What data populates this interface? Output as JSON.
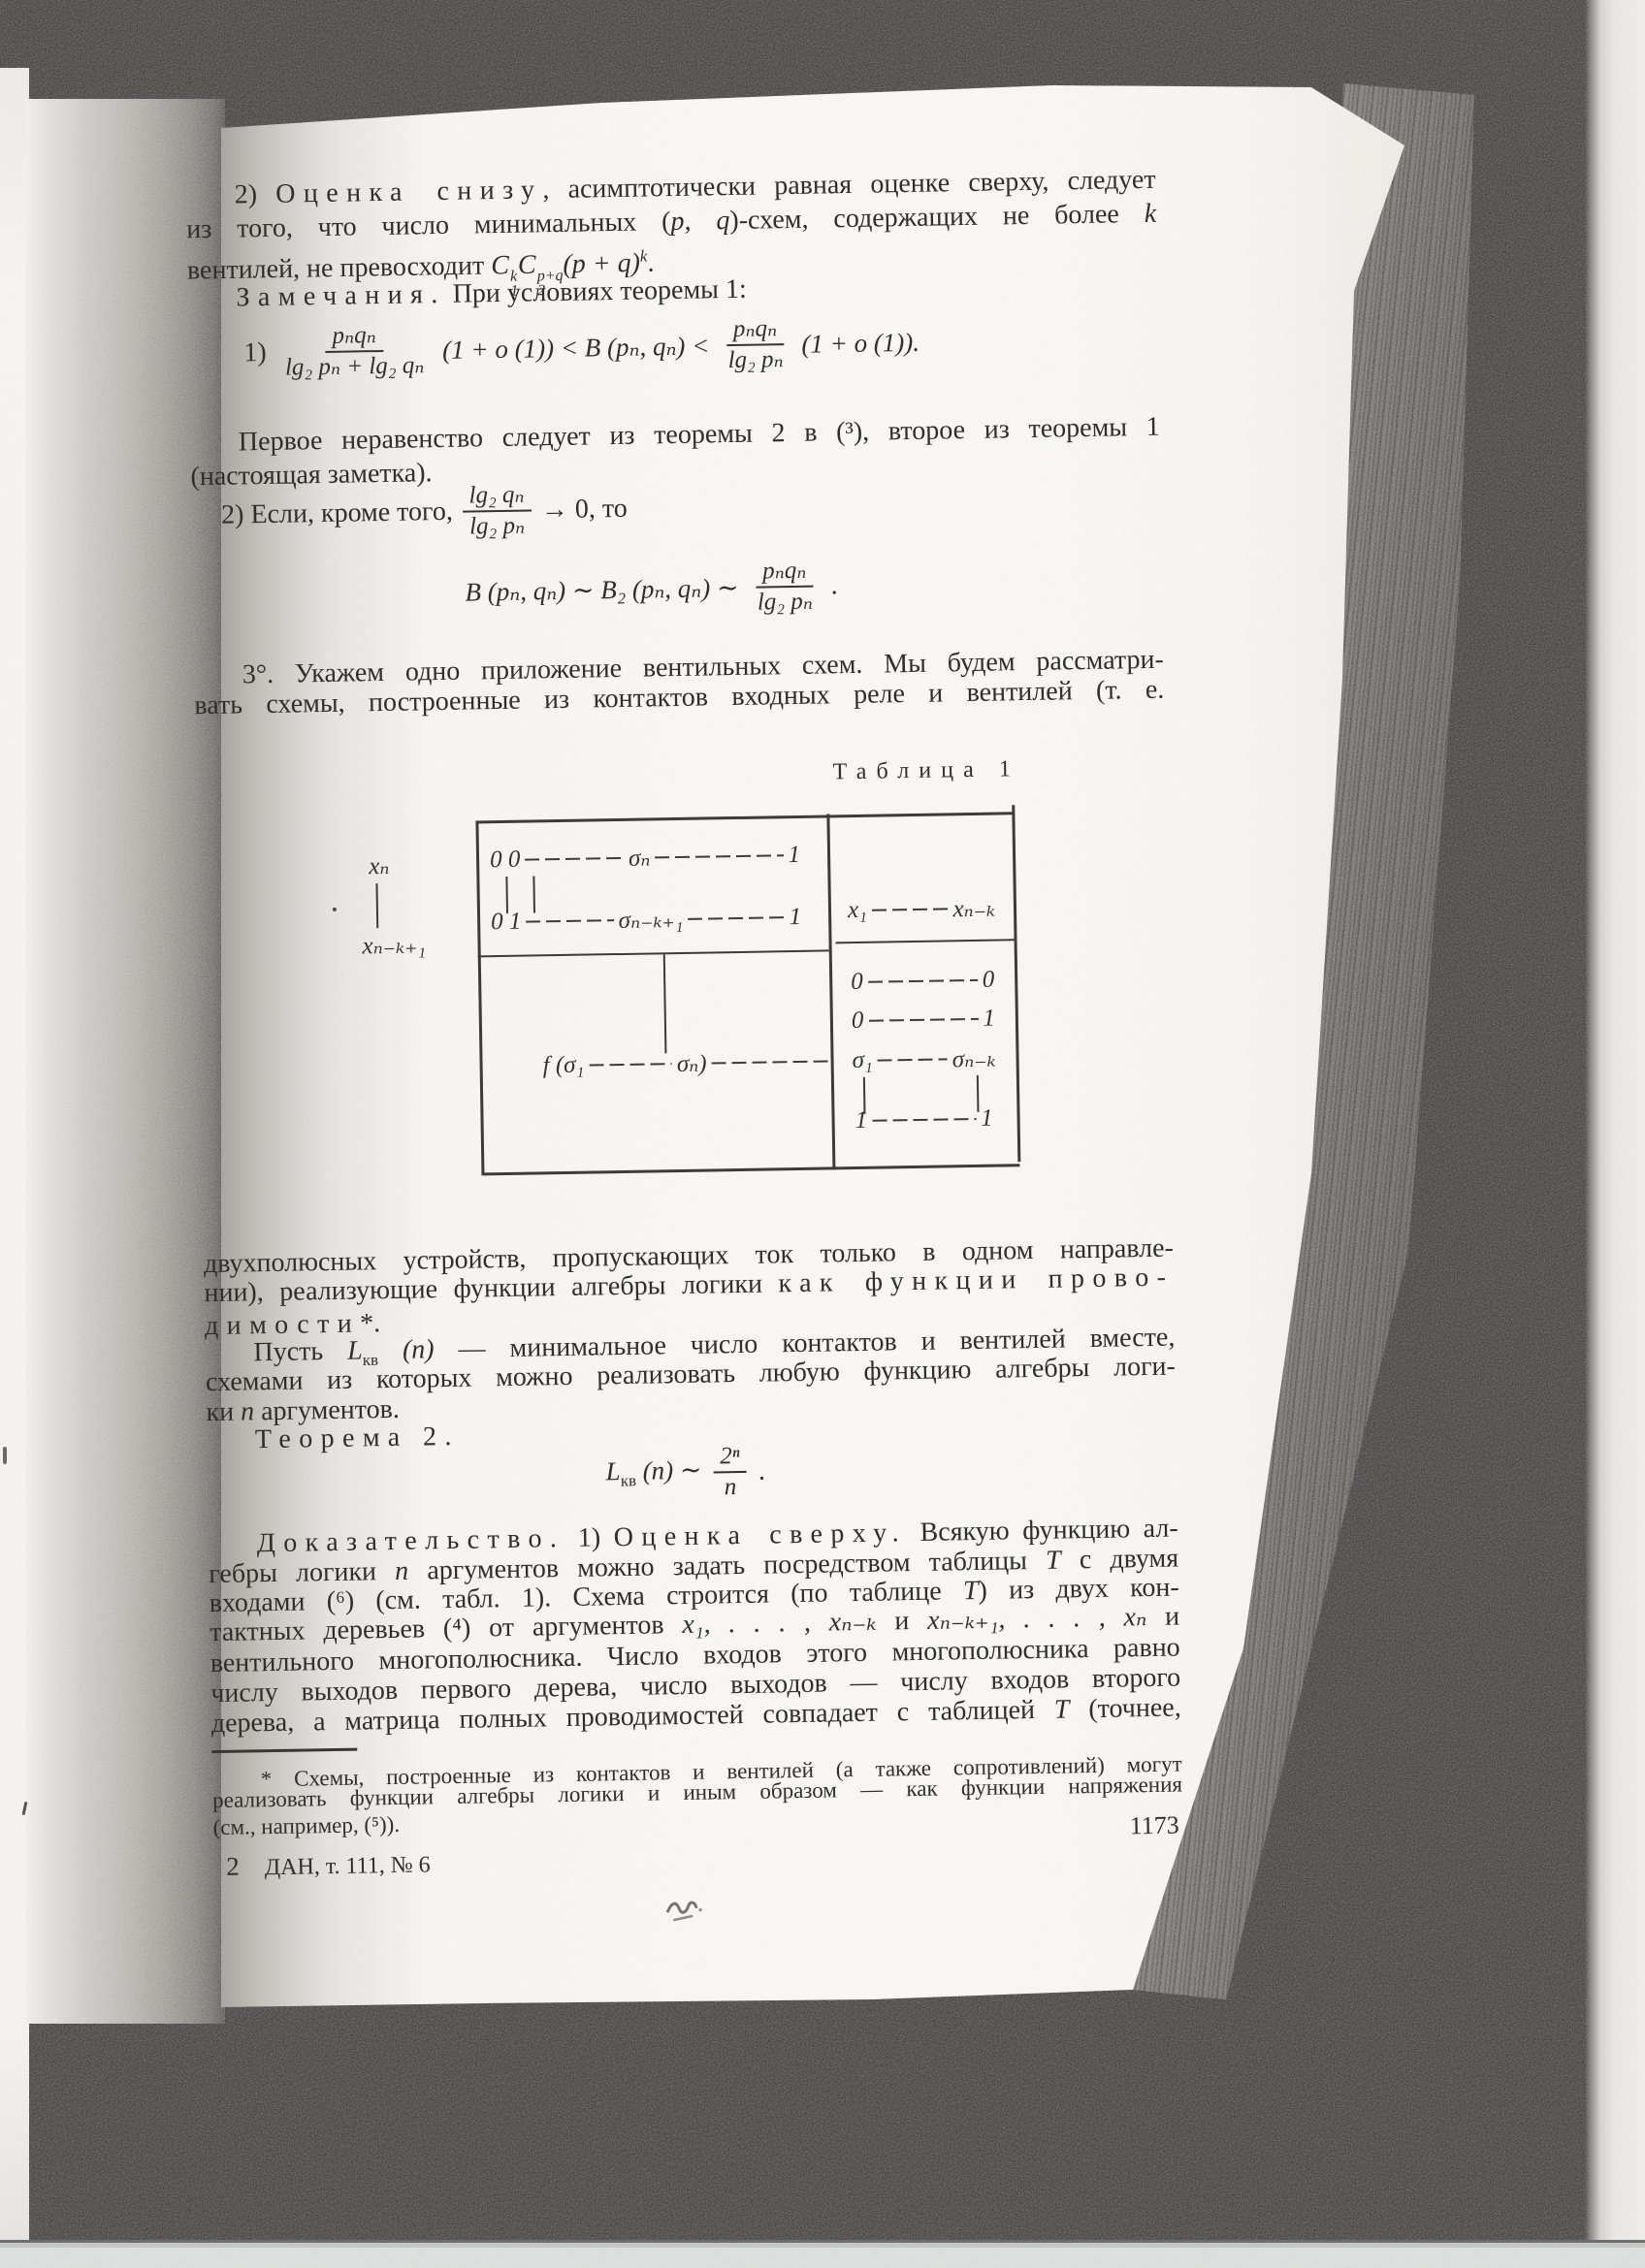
{
  "meta": {
    "page_number": "1173",
    "signature_num": "2",
    "signature": "ДАН, т. 111, № 6"
  },
  "body": {
    "p1l1": [
      {
        "t": "2) "
      },
      {
        "t": "Оценка снизу",
        "c": "sp"
      },
      {
        "t": ", асимптотически равная оценке сверху, следует"
      }
    ],
    "p1l2": [
      {
        "t": "из того, что число минимальных ("
      },
      {
        "t": "p, q",
        "c": "it"
      },
      {
        "t": ")-схем, содержащих не более "
      },
      {
        "t": "k",
        "c": "it"
      }
    ],
    "p1l3pre": "вентилей, не превосходит ",
    "p1l4": [
      {
        "t": "Замечания.",
        "c": "sp"
      },
      {
        "t": " При условиях теоремы 1:"
      }
    ],
    "p2l1": [
      {
        "t": "Первое неравенство следует из теоремы 2 в (³), второе из теоремы 1"
      }
    ],
    "p2l2": [
      {
        "t": "(настоящая заметка)."
      }
    ],
    "p3pre": "2) Если, кроме того, ",
    "p3post": "→ 0,  то",
    "p4l1": [
      {
        "t": "3°. Укажем одно приложение вентильных схем. Мы будем рассматри-"
      }
    ],
    "p4l2": [
      {
        "t": "вать схемы, построенные из контактов входных реле и вентилей (т. е."
      }
    ],
    "p5l1": [
      {
        "t": "двухполюсных устройств, пропускающих ток только в одном направле-"
      }
    ],
    "p5l2": [
      {
        "t": "нии), реализующие функции алгебры логики "
      },
      {
        "t": "как функции прово-",
        "c": "sp"
      }
    ],
    "p5l3": [
      {
        "t": "димости",
        "c": "sp"
      },
      {
        "t": "*."
      }
    ],
    "p6l1a": "Пусть ",
    "p6l1n": " (n)",
    "p6l1b": " — минимальное число контактов и вентилей вместе,",
    "p6l2": [
      {
        "t": "схемами из которых можно реализовать любую функцию алгебры логи-"
      }
    ],
    "p6l3": [
      {
        "t": "ки "
      },
      {
        "t": "n",
        "c": "it"
      },
      {
        "t": " аргументов."
      }
    ],
    "p7": [
      {
        "t": "Теорема 2.",
        "c": "sp"
      }
    ],
    "p8l1": [
      {
        "t": "Доказательство.",
        "c": "sp"
      },
      {
        "t": " 1) "
      },
      {
        "t": "Оценка сверху.",
        "c": "sp"
      },
      {
        "t": " Всякую функцию ал-"
      }
    ],
    "p8l2": [
      {
        "t": "гебры логики "
      },
      {
        "t": "n",
        "c": "it"
      },
      {
        "t": " аргументов можно задать посредством таблицы "
      },
      {
        "t": "T",
        "c": "it"
      },
      {
        "t": " с двумя"
      }
    ],
    "p8l3": [
      {
        "t": "входами (⁶) (см. табл. 1). Схема строится (по таблице "
      },
      {
        "t": "T",
        "c": "it"
      },
      {
        "t": ") из двух кон-"
      }
    ],
    "p8l4": [
      {
        "t": "тактных деревьев (⁴) от аргументов "
      },
      {
        "t": "x₁, . . . , xₙ₋ₖ",
        "c": "it"
      },
      {
        "t": " и "
      },
      {
        "t": "xₙ₋ₖ₊₁, . . . , xₙ",
        "c": "it"
      },
      {
        "t": " и"
      }
    ],
    "p8l5": [
      {
        "t": "вентильного многополюсника. Число входов этого многополюсника равно"
      }
    ],
    "p8l6": [
      {
        "t": "числу выходов первого дерева, число выходов — числу входов второго"
      }
    ],
    "p8l7": [
      {
        "t": "дерева, а матрица полных проводимостей совпадает с таблицей "
      },
      {
        "t": "T",
        "c": "it"
      },
      {
        "t": " (точнее,"
      }
    ],
    "fn1": [
      {
        "t": "* Схемы, построенные из контактов и вентилей (а также сопротивлений) могут"
      }
    ],
    "fn2": [
      {
        "t": "реализовать функции алгебры логики и иным образом — как функции напряжения"
      }
    ],
    "fn3": [
      {
        "t": "(см., например, (⁵))."
      }
    ]
  },
  "eq": {
    "cck": {
      "C": "C",
      "sup1": "k",
      "sub1": "1",
      "sup2": "p+q",
      "sub2": "2",
      "tail": "(p + q)",
      "sup3": "k",
      "end": "."
    },
    "e1no": "1)",
    "e1f1num": "pₙqₙ",
    "e1f1den": "lg₂ pₙ + lg₂ qₙ",
    "e1mid": "(1 + o (1)) < B (pₙ, qₙ) <",
    "e1f2num": "pₙqₙ",
    "e1f2den": "lg₂ pₙ",
    "e1tail": "(1 + o (1)).",
    "e2num": "lg₂ qₙ",
    "e2den": "lg₂ pₙ",
    "e3lead": "B (pₙ, qₙ) ∼ B₂ (pₙ, qₙ) ∼",
    "e3num": "pₙqₙ",
    "e3den": "lg₂ pₙ",
    "e3end": ".",
    "e4L": "L",
    "e4sub": "кв",
    "e4midsp": " (n) ∼",
    "e4num": "2ⁿ",
    "e4den": "n",
    "e4end": "."
  },
  "table": {
    "caption": "Таблица 1",
    "side_top": "xₙ",
    "side_bot": "xₙ₋ₖ₊₁",
    "h1a": "0 0",
    "h1b": "σₙ",
    "h1c": "1",
    "h2a": "0 1",
    "h2b": "σₙ₋ₖ₊₁",
    "h2c": "1",
    "hr_a": "x₁",
    "hr_b": "xₙ₋ₖ",
    "fa": "f (σ₁",
    "fb": "σₙ)",
    "r1a": "0",
    "r1b": "0",
    "r2a": "0",
    "r2b": "1",
    "r3a": "σ₁",
    "r3b": "σₙ₋ₖ",
    "r4a": "1",
    "r4b": "1"
  }
}
